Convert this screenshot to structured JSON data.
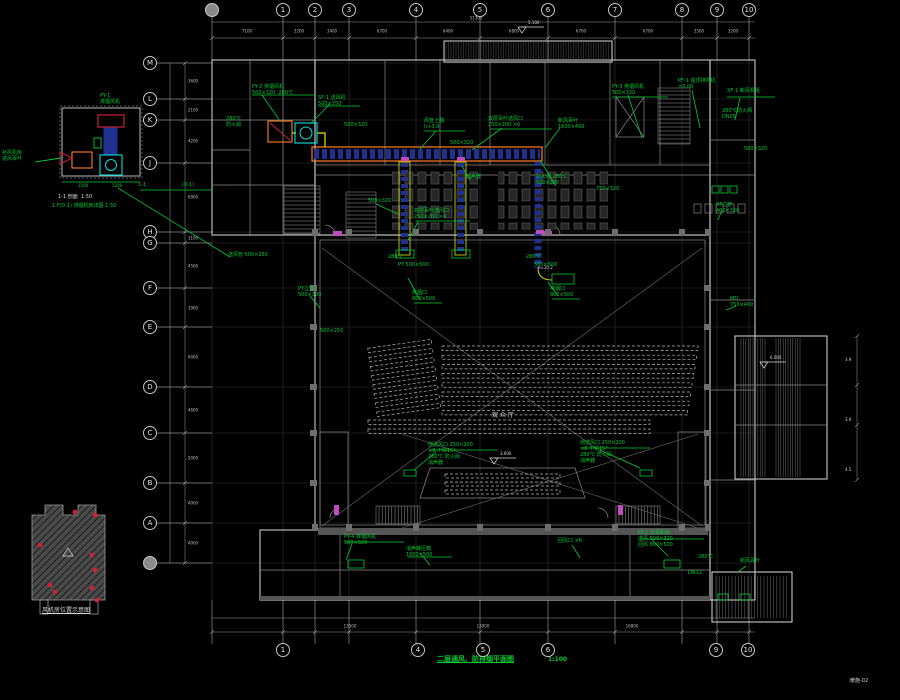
{
  "title_block": {
    "title": "二层通风、防排烟平面图",
    "scale": "1:100",
    "sheet_no": "暖施-02"
  },
  "details": {
    "section_caption": "1-1 剖面  1:50",
    "detail_caption": "1-F(0-1) 排烟机房详图 1:50",
    "locator_caption": "风机房位置示意图",
    "section_mark_left": "1-1",
    "section_mark_right": "(0-1)"
  },
  "colors": {
    "annotation": "#00cc33",
    "duct_outline": "#ff7f27",
    "duct_inner": "#20308f",
    "fan": "#00e0e0",
    "alert": "#cc2233",
    "opening": "#c04ac0",
    "walls": "#c8c8c8"
  },
  "axes": {
    "top": [
      {
        "x": 212,
        "label": ""
      },
      {
        "x": 283,
        "label": "1"
      },
      {
        "x": 315,
        "label": "2"
      },
      {
        "x": 349,
        "label": "3"
      },
      {
        "x": 416,
        "label": "4"
      },
      {
        "x": 480,
        "label": "5"
      },
      {
        "x": 548,
        "label": "6"
      },
      {
        "x": 615,
        "label": "7"
      },
      {
        "x": 682,
        "label": "8"
      },
      {
        "x": 717,
        "label": "9"
      },
      {
        "x": 749,
        "label": "10"
      }
    ],
    "bottom": [
      {
        "x": 283,
        "label": "1"
      },
      {
        "x": 418,
        "label": "4"
      },
      {
        "x": 483,
        "label": "5"
      },
      {
        "x": 548,
        "label": "6"
      },
      {
        "x": 716,
        "label": "9"
      },
      {
        "x": 748,
        "label": "10"
      }
    ],
    "left": [
      {
        "y": 63,
        "label": "M"
      },
      {
        "y": 99,
        "label": "L"
      },
      {
        "y": 120,
        "label": "K"
      },
      {
        "y": 163,
        "label": "J"
      },
      {
        "y": 232,
        "label": "H"
      },
      {
        "y": 243,
        "label": "G"
      },
      {
        "y": 288,
        "label": "F"
      },
      {
        "y": 327,
        "label": "E"
      },
      {
        "y": 387,
        "label": "D"
      },
      {
        "y": 433,
        "label": "C"
      },
      {
        "y": 483,
        "label": "B"
      },
      {
        "y": 523,
        "label": "A"
      },
      {
        "y": 563,
        "label": ""
      }
    ]
  },
  "dims": {
    "top": [
      {
        "x": 247,
        "t": "7100"
      },
      {
        "x": 299,
        "t": "3200"
      },
      {
        "x": 332,
        "t": "3400"
      },
      {
        "x": 382,
        "t": "6700"
      },
      {
        "x": 448,
        "t": "6400"
      },
      {
        "x": 514,
        "t": "6800"
      },
      {
        "x": 581,
        "t": "6700"
      },
      {
        "x": 648,
        "t": "6700"
      },
      {
        "x": 699,
        "t": "3500"
      },
      {
        "x": 733,
        "t": "3200"
      }
    ],
    "bottom": [
      {
        "x": 350,
        "t": "13500"
      },
      {
        "x": 483,
        "t": "13000"
      },
      {
        "x": 632,
        "t": "16800"
      }
    ],
    "left": [
      {
        "y": 81,
        "t": "3600"
      },
      {
        "y": 110,
        "t": "2100"
      },
      {
        "y": 141,
        "t": "4200"
      },
      {
        "y": 197,
        "t": "6900"
      },
      {
        "y": 238,
        "t": "1100"
      },
      {
        "y": 266,
        "t": "4500"
      },
      {
        "y": 308,
        "t": "3900"
      },
      {
        "y": 357,
        "t": "6000"
      },
      {
        "y": 410,
        "t": "4600"
      },
      {
        "y": 458,
        "t": "5000"
      },
      {
        "y": 503,
        "t": "4000"
      },
      {
        "y": 543,
        "t": "4000"
      }
    ]
  },
  "levels": [
    {
      "x": 522,
      "y": 27,
      "t": "5.100"
    },
    {
      "x": 494,
      "y": 458,
      "t": "3.600"
    },
    {
      "x": 764,
      "y": 362,
      "t": "6.000"
    }
  ],
  "overall_dim": {
    "x": 476,
    "y": 18,
    "t": "51300"
  },
  "annotations": [
    {
      "x": 2,
      "y": 150,
      "t": "补风机房\n进风百叶"
    },
    {
      "x": 100,
      "y": 93,
      "t": "PY-1\n排烟风机"
    },
    {
      "x": 78,
      "y": 184,
      "t": "1500",
      "s": 4
    },
    {
      "x": 112,
      "y": 184,
      "t": "1200",
      "s": 4
    },
    {
      "x": 58,
      "y": 194,
      "t": "1-1 剖面  1:50",
      "c": "w"
    },
    {
      "x": 52,
      "y": 203,
      "t": "1-F(0-1) 排烟机房详图 1:50"
    },
    {
      "x": 138,
      "y": 182,
      "t": "1-1"
    },
    {
      "x": 182,
      "y": 182,
      "t": "(0-1)"
    },
    {
      "x": 228,
      "y": 252,
      "t": "送风管 500×250"
    },
    {
      "x": 252,
      "y": 84,
      "t": "PY-2 排烟风机\n500×320  280℃"
    },
    {
      "x": 318,
      "y": 95,
      "t": "SF-1 送风机\n500×250"
    },
    {
      "x": 226,
      "y": 116,
      "t": "280℃\n防火阀"
    },
    {
      "x": 344,
      "y": 122,
      "t": "500×320"
    },
    {
      "x": 424,
      "y": 118,
      "t": "风管上翻\nh+3.9"
    },
    {
      "x": 450,
      "y": 140,
      "t": "500×320"
    },
    {
      "x": 488,
      "y": 116,
      "t": "双层百叶送风口\n250×200 ×6"
    },
    {
      "x": 558,
      "y": 118,
      "t": "新风百叶\n1600×400"
    },
    {
      "x": 612,
      "y": 84,
      "t": "PY-3 排烟风机\n500×320"
    },
    {
      "x": 678,
      "y": 78,
      "t": "PF-1 屋顶排风机\n±0.00"
    },
    {
      "x": 727,
      "y": 88,
      "t": "XF-1 新风机组"
    },
    {
      "x": 722,
      "y": 108,
      "t": "280℃防火阀\nDN25"
    },
    {
      "x": 744,
      "y": 146,
      "t": "500×320"
    },
    {
      "x": 368,
      "y": 198,
      "t": "500×320"
    },
    {
      "x": 466,
      "y": 174,
      "t": "消声器"
    },
    {
      "x": 536,
      "y": 174,
      "t": "防火阀 280℃\n500×320"
    },
    {
      "x": 596,
      "y": 186,
      "t": "750×320"
    },
    {
      "x": 414,
      "y": 208,
      "t": "双层百叶送风口\n250×200 ×4"
    },
    {
      "x": 388,
      "y": 254,
      "t": "280℃"
    },
    {
      "x": 398,
      "y": 262,
      "t": "PY 500×500"
    },
    {
      "x": 526,
      "y": 254,
      "t": "280℃"
    },
    {
      "x": 534,
      "y": 262,
      "t": "500×500"
    },
    {
      "x": 412,
      "y": 290,
      "t": "排烟口\n800×500"
    },
    {
      "x": 550,
      "y": 286,
      "t": "排烟口\n800×500"
    },
    {
      "x": 298,
      "y": 286,
      "t": "PY立管\n500×320"
    },
    {
      "x": 320,
      "y": 328,
      "t": "500×250"
    },
    {
      "x": 538,
      "y": 266,
      "t": "h=10.2",
      "c": "w",
      "s": 4
    },
    {
      "x": 428,
      "y": 442,
      "t": "侧送风口 250×200\n×8 下倾15°\n280℃ 防火阀\n消声器"
    },
    {
      "x": 580,
      "y": 440,
      "t": "侧送风口 250×200\n×8 下倾15°\n280℃ 防火阀\n消声器"
    },
    {
      "x": 344,
      "y": 534,
      "t": "PY-4 排烟风机\n500×320"
    },
    {
      "x": 406,
      "y": 546,
      "t": "消声静压箱\n1000×500"
    },
    {
      "x": 558,
      "y": 538,
      "t": "回风口 ×6"
    },
    {
      "x": 638,
      "y": 530,
      "t": "KT-1 空调机房\n送风 500×320\n回风 800×500"
    },
    {
      "x": 698,
      "y": 554,
      "t": "280℃"
    },
    {
      "x": 740,
      "y": 558,
      "t": "新风百叶"
    },
    {
      "x": 688,
      "y": 570,
      "t": "DN32"
    },
    {
      "x": 716,
      "y": 202,
      "t": "XF立管\n400×320"
    },
    {
      "x": 730,
      "y": 296,
      "t": "MD\n750×400"
    },
    {
      "x": 845,
      "y": 358,
      "t": "3.9",
      "c": "w",
      "s": 4
    },
    {
      "x": 845,
      "y": 418,
      "t": "3.9",
      "c": "w",
      "s": 4
    },
    {
      "x": 845,
      "y": 468,
      "t": "4.5",
      "c": "w",
      "s": 4
    },
    {
      "x": 492,
      "y": 412,
      "t": "观 众 厅",
      "c": "w",
      "s": 6
    }
  ]
}
